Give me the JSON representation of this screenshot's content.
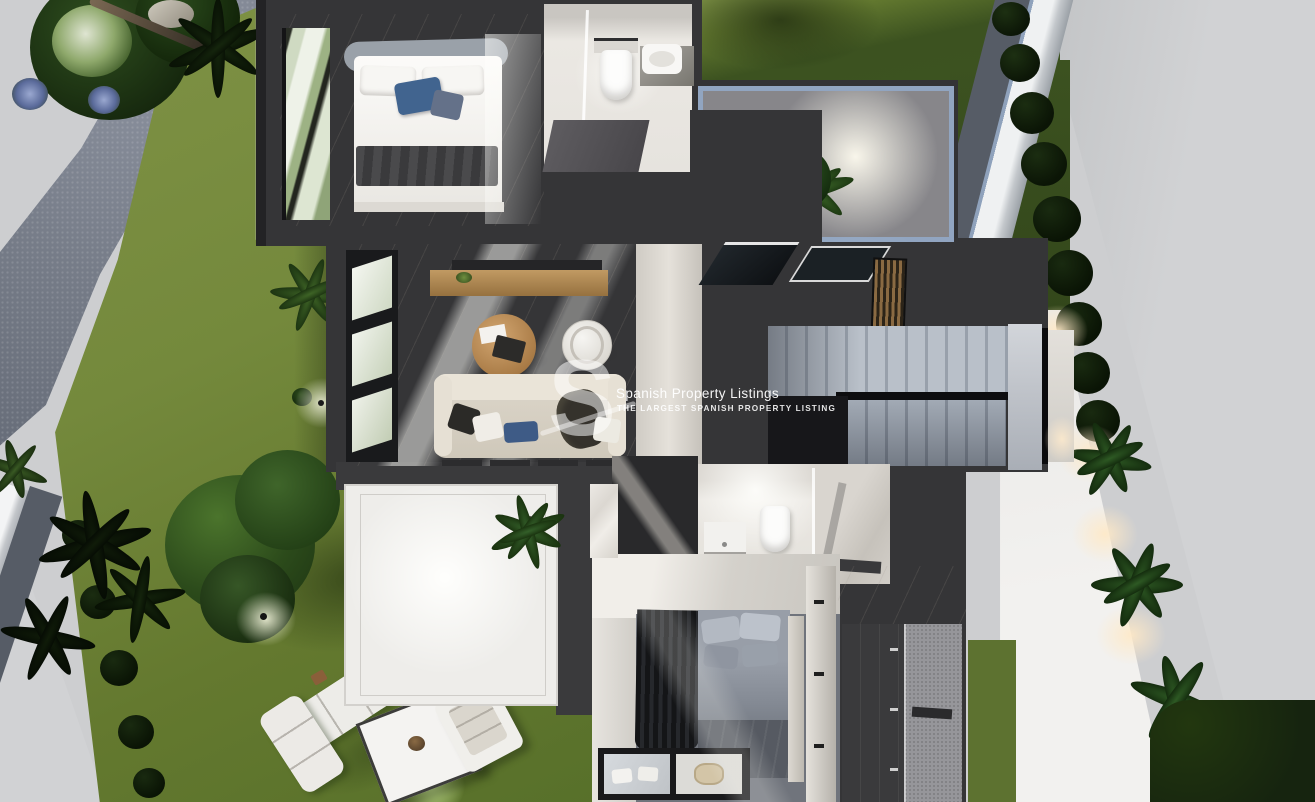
{
  "image": {
    "width": 1315,
    "height": 802,
    "kind": "3d-floorplan-render",
    "description": "Top-down cutaway render of a modern villa floor with surrounding garden"
  },
  "watermark": {
    "logo_letter": "S",
    "title": "Spanish Property Listings",
    "subtitle": "THE LARGEST SPANISH PROPERTY LISTING"
  },
  "colors": {
    "street": "#cdced0",
    "street_shade": "#c0c2c4",
    "boundary_wall": "#eff1f2",
    "gravel": "#5d636c",
    "lawn": "#71863a",
    "lawn_light": "#7f9245",
    "lawn_dark": "#3d5420",
    "hedge": "#16240f",
    "foliage": "#2f4f1f",
    "foliage_dark": "#0e1c0a",
    "house_wall": "#353537",
    "house_wall_dark": "#232325",
    "marble": "#ece9e4",
    "marble_dim": "#cfcbc4",
    "stair_light": "#b9c0c9",
    "stair_dark": "#828a96",
    "glass_blue": "#92a8c6",
    "wood": "#b5854f",
    "sofa_beige": "#ddd7cb",
    "pillow_blue": "#41648f",
    "glow_warm": "#ffe9c6",
    "glow_white": "#fffdf4",
    "watermark": "#ffffff"
  },
  "scene": {
    "rooms": [
      "bedroom-1",
      "bathroom-1",
      "courtyard-lightwell",
      "living-room",
      "hallway-skylights",
      "staircase",
      "bathroom-2",
      "bedroom-2",
      "wardrobe",
      "walk-in-shower",
      "terrace"
    ],
    "garden": [
      "lawn",
      "gravel-path",
      "palm-trees",
      "large-tree",
      "shrubs",
      "flower-beds",
      "boundary-wall",
      "bush-row",
      "outdoor-lounge-set",
      "lawn-spotlights",
      "pathway-lights",
      "street"
    ]
  }
}
